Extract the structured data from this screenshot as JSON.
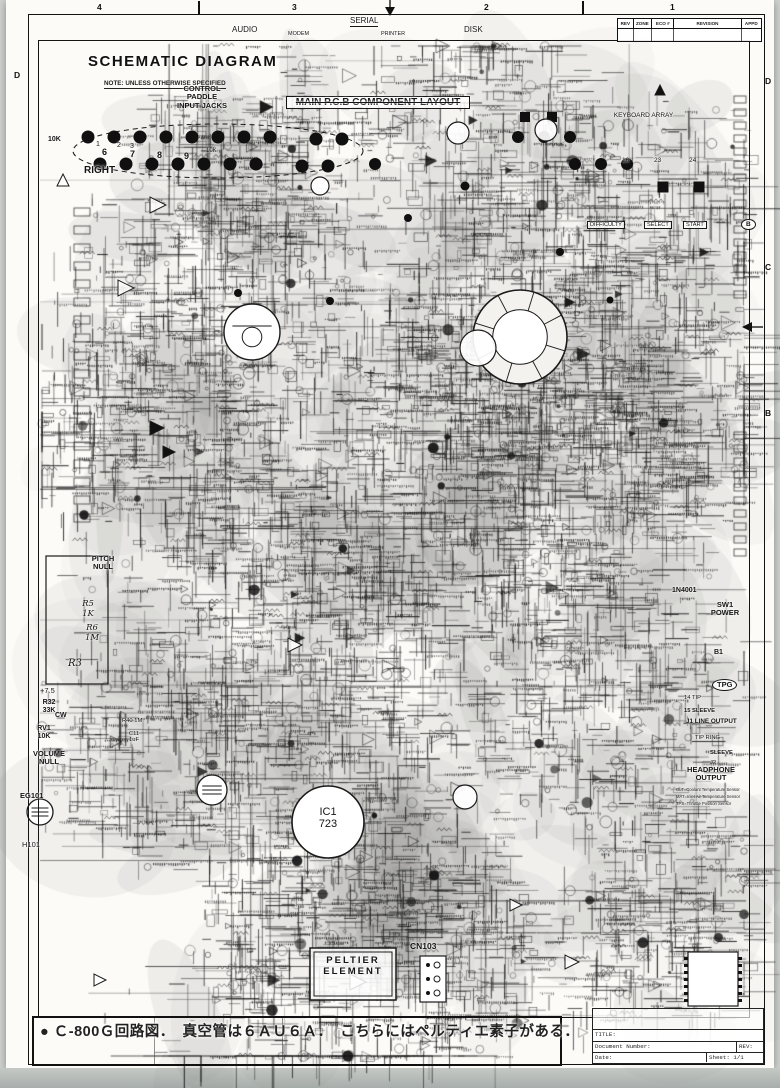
{
  "header": {
    "title": "SCHEMATIC DIAGRAM",
    "note": "NOTE: UNLESS OTHERWISE SPECIFIED"
  },
  "zones": {
    "top": [
      {
        "label": "4",
        "x": 100
      },
      {
        "label": "3",
        "x": 295
      },
      {
        "label": "2",
        "x": 487
      },
      {
        "label": "1",
        "x": 673
      }
    ],
    "left": [
      {
        "label": "D",
        "y": 70
      }
    ],
    "right": [
      {
        "label": "D",
        "y": 76
      },
      {
        "label": "C",
        "y": 262
      },
      {
        "label": "B",
        "y": 408
      }
    ],
    "ticks_top": [
      198,
      582
    ]
  },
  "revision_table": {
    "headers": [
      "REV",
      "ZONE",
      "ECO #",
      "REVISION",
      "APPD"
    ]
  },
  "title_block": {
    "title_label": "TITLE:",
    "doc_label": "Document Number:",
    "rev_label": "REV:",
    "date_label": "Date:",
    "sheet_label": "Sheet: 1/1"
  },
  "caption": {
    "text": "● Ｃ-800Ｇ回路図．　真空管は６ＡＵ６Ａ．　こちらにはペルティエ素子がある．"
  },
  "colors": {
    "ink": "#1a1a1a",
    "paper": "#fcfbf8",
    "smudge": "#8a8a8a"
  },
  "callouts": [
    {
      "name": "label-audio",
      "text": "AUDIO",
      "x": 232,
      "y": 26,
      "size": 8
    },
    {
      "name": "label-serial",
      "text": "SERIAL",
      "x": 350,
      "y": 17,
      "size": 8,
      "underline": true
    },
    {
      "name": "label-modem",
      "text": "MODEM",
      "x": 288,
      "y": 31,
      "size": 5.5
    },
    {
      "name": "label-printer",
      "text": "PRINTER",
      "x": 381,
      "y": 31,
      "size": 5.5
    },
    {
      "name": "label-disk",
      "text": "DISK",
      "x": 464,
      "y": 26,
      "size": 8
    },
    {
      "name": "label-control-paddle-input-jacks",
      "text": "CONTROL\nPADDLE\nINPUT JACKS",
      "x": 166,
      "y": 85,
      "size": 7.5,
      "w": 72,
      "bold": true
    },
    {
      "name": "label-10k-a",
      "text": "10K",
      "x": 48,
      "y": 136,
      "size": 7,
      "bold": true
    },
    {
      "name": "label-10k-b",
      "text": "10K",
      "x": 206,
      "y": 148,
      "size": 6
    },
    {
      "name": "label-right",
      "text": "RIGHT",
      "x": 84,
      "y": 165,
      "size": 10,
      "bold": true
    },
    {
      "name": "label-num-1",
      "text": "1",
      "x": 96,
      "y": 141,
      "size": 7
    },
    {
      "name": "label-num-2",
      "text": "2",
      "x": 117,
      "y": 142,
      "size": 7
    },
    {
      "name": "label-num-3",
      "text": "3",
      "x": 130,
      "y": 143,
      "size": 7
    },
    {
      "name": "label-num-6",
      "text": "6",
      "x": 102,
      "y": 147,
      "size": 9,
      "bold": true
    },
    {
      "name": "label-num-7",
      "text": "7",
      "x": 130,
      "y": 149,
      "size": 9,
      "bold": true
    },
    {
      "name": "label-num-8",
      "text": "8",
      "x": 157,
      "y": 150,
      "size": 9,
      "bold": true
    },
    {
      "name": "label-num-9",
      "text": "9",
      "x": 184,
      "y": 151,
      "size": 9,
      "bold": true
    },
    {
      "name": "label-main-pcb-layout",
      "text": "MAIN P.C.B COMPONENT LAYOUT",
      "x": 286,
      "y": 96,
      "size": 10,
      "bold": true,
      "box": true,
      "w": 178,
      "strike": true
    },
    {
      "name": "label-keyboard-array",
      "text": "KEYBOARD ARRAY",
      "x": 596,
      "y": 112,
      "size": 6.5,
      "w": 95
    },
    {
      "name": "label-pin-16",
      "text": "16",
      "x": 622,
      "y": 157,
      "size": 6.5
    },
    {
      "name": "label-pin-23",
      "text": "23",
      "x": 654,
      "y": 157,
      "size": 6.5
    },
    {
      "name": "label-pin-24",
      "text": "24",
      "x": 689,
      "y": 157,
      "size": 6.5
    },
    {
      "name": "label-difficulty",
      "text": "DIFFICULTY",
      "x": 587,
      "y": 221,
      "size": 5.6,
      "box": true
    },
    {
      "name": "label-select",
      "text": "SELECT",
      "x": 644,
      "y": 221,
      "size": 5.6,
      "box": true
    },
    {
      "name": "label-start",
      "text": "START",
      "x": 683,
      "y": 221,
      "size": 5.6,
      "box": true
    },
    {
      "name": "balloon-b",
      "text": "B",
      "x": 741,
      "y": 219,
      "size": 6.5,
      "oval": true,
      "bold": true
    },
    {
      "name": "label-pitch-null",
      "text": "PITCH\nNULL",
      "x": 84,
      "y": 555,
      "size": 7.5,
      "bold": true,
      "w": 38
    },
    {
      "name": "label-r5-1k",
      "text": "R5\n1K",
      "x": 76,
      "y": 600,
      "size": 8.5,
      "w": 24,
      "italic": true
    },
    {
      "name": "label-r6-1m",
      "text": "R6\n1M",
      "x": 80,
      "y": 624,
      "size": 8.5,
      "w": 24,
      "italic": true
    },
    {
      "name": "label-r3",
      "text": "R3",
      "x": 68,
      "y": 658,
      "size": 10,
      "italic": true
    },
    {
      "name": "label-plus-7-5",
      "text": "+7.5",
      "x": 40,
      "y": 687,
      "size": 7.5
    },
    {
      "name": "label-r32-33k",
      "text": "R32\n33K",
      "x": 36,
      "y": 699,
      "size": 7,
      "bold": true,
      "w": 26
    },
    {
      "name": "label-cw",
      "text": "CW",
      "x": 55,
      "y": 712,
      "size": 7,
      "bold": true
    },
    {
      "name": "label-rv1-10k",
      "text": "RV1\n10K",
      "x": 31,
      "y": 725,
      "size": 7,
      "bold": true,
      "w": 26
    },
    {
      "name": "label-r40-1m",
      "text": "R40 1M",
      "x": 122,
      "y": 718,
      "size": 5.8
    },
    {
      "name": "label-c11-1uf",
      "text": "C11\n1uF",
      "x": 124,
      "y": 731,
      "size": 5.8,
      "w": 20
    },
    {
      "name": "label-volume-null",
      "text": "VOLUME\nNULL",
      "x": 26,
      "y": 750,
      "size": 7.5,
      "bold": true,
      "w": 46
    },
    {
      "name": "label-eg101",
      "text": "EG101",
      "x": 20,
      "y": 792,
      "size": 7.5,
      "bold": true
    },
    {
      "name": "label-h101",
      "text": "H101",
      "x": 22,
      "y": 841,
      "size": 7.5
    },
    {
      "name": "label-ic1-723",
      "text": "IC1\n723",
      "x": 303,
      "y": 806,
      "size": 11,
      "w": 50
    },
    {
      "name": "label-peltier-element",
      "text": "PELTIER\nELEMENT",
      "x": 316,
      "y": 956,
      "size": 9.5,
      "bold": true,
      "w": 74,
      "spaced": true
    },
    {
      "name": "label-cn103",
      "text": "CN103",
      "x": 410,
      "y": 942,
      "size": 8.5,
      "bold": true
    },
    {
      "name": "label-1n4001",
      "text": "1N4001",
      "x": 672,
      "y": 587,
      "size": 7,
      "bold": true
    },
    {
      "name": "label-sw1-power",
      "text": "SW1\nPOWER",
      "x": 704,
      "y": 601,
      "size": 7.5,
      "bold": true,
      "w": 42
    },
    {
      "name": "label-b1",
      "text": "B1",
      "x": 714,
      "y": 649,
      "size": 7,
      "bold": true
    },
    {
      "name": "label-tpg",
      "text": "TPG",
      "x": 712,
      "y": 679,
      "size": 7.5,
      "bold": true,
      "oval": true
    },
    {
      "name": "label-14-tip",
      "text": "14  TIP",
      "x": 684,
      "y": 695,
      "size": 5.8
    },
    {
      "name": "label-15-sleeve",
      "text": "15   SLEEVE",
      "x": 684,
      "y": 708,
      "size": 5.8,
      "bold": true
    },
    {
      "name": "label-j1-line-output",
      "text": "J1 LINE OUTPUT",
      "x": 686,
      "y": 718,
      "size": 6.3,
      "bold": true
    },
    {
      "name": "label-tip-ring",
      "text": "TIP  RING",
      "x": 695,
      "y": 735,
      "size": 5.8
    },
    {
      "name": "label-sleeve",
      "text": "SLEEVE",
      "x": 710,
      "y": 750,
      "size": 5.8,
      "bold": true
    },
    {
      "name": "label-j2",
      "text": "J2",
      "x": 710,
      "y": 760,
      "size": 5.8
    },
    {
      "name": "label-headphone-output",
      "text": "HEADPHONE\nOUTPUT",
      "x": 678,
      "y": 766,
      "size": 7.5,
      "bold": true,
      "w": 66
    },
    {
      "name": "label-olt-sensor",
      "text": "OLT=Coolant Temperature Sensor",
      "x": 676,
      "y": 788,
      "size": 4.2
    },
    {
      "name": "label-mat-sensor",
      "text": "MAT=Inlet Air Temperature Sensor",
      "x": 676,
      "y": 795,
      "size": 4.2
    },
    {
      "name": "label-tps-sensor",
      "text": "TPS=Throttle Position Sensor",
      "x": 676,
      "y": 802,
      "size": 4.2
    }
  ],
  "diagram": {
    "dots": [
      [
        88,
        137,
        6.5
      ],
      [
        114,
        137,
        6.5
      ],
      [
        140,
        137,
        6.5
      ],
      [
        166,
        137,
        6.5
      ],
      [
        192,
        137,
        6.5
      ],
      [
        218,
        137,
        6.5
      ],
      [
        244,
        137,
        6.5
      ],
      [
        270,
        137,
        6.5
      ],
      [
        316,
        139,
        6.5
      ],
      [
        342,
        139,
        6.5
      ],
      [
        518,
        137,
        6
      ],
      [
        544,
        137,
        6
      ],
      [
        570,
        137,
        6
      ],
      [
        100,
        164,
        6.5
      ],
      [
        126,
        164,
        6.5
      ],
      [
        152,
        164,
        6.5
      ],
      [
        178,
        164,
        6.5
      ],
      [
        204,
        164,
        6.5
      ],
      [
        230,
        164,
        6.5
      ],
      [
        256,
        164,
        6.5
      ],
      [
        302,
        166,
        6.5
      ],
      [
        328,
        166,
        6.5
      ],
      [
        375,
        164,
        6
      ],
      [
        575,
        164,
        6
      ],
      [
        601,
        164,
        6
      ],
      [
        627,
        164,
        6
      ],
      [
        330,
        301,
        4
      ],
      [
        238,
        293,
        4
      ],
      [
        465,
        186,
        4.5
      ],
      [
        408,
        218,
        4
      ],
      [
        560,
        252,
        4
      ],
      [
        610,
        300,
        3.5
      ]
    ],
    "squares": [
      [
        663,
        187,
        11
      ],
      [
        699,
        187,
        11
      ],
      [
        525,
        117,
        10
      ],
      [
        552,
        117,
        10
      ]
    ],
    "circles": [
      {
        "cx": 252,
        "cy": 332,
        "r": 28,
        "kind": "tube"
      },
      {
        "cx": 520,
        "cy": 337,
        "r": 47,
        "kind": "tube-big"
      },
      {
        "cx": 478,
        "cy": 348,
        "r": 18,
        "kind": "plain"
      },
      {
        "cx": 328,
        "cy": 822,
        "r": 36,
        "kind": "ic"
      },
      {
        "cx": 40,
        "cy": 812,
        "r": 13,
        "kind": "tube-small"
      },
      {
        "cx": 212,
        "cy": 790,
        "r": 15,
        "kind": "tube-small"
      },
      {
        "cx": 458,
        "cy": 133,
        "r": 11,
        "kind": "plain"
      },
      {
        "cx": 546,
        "cy": 130,
        "r": 11,
        "kind": "plain"
      },
      {
        "cx": 320,
        "cy": 186,
        "r": 9,
        "kind": "plain"
      },
      {
        "cx": 465,
        "cy": 797,
        "r": 12,
        "kind": "plain"
      }
    ],
    "triangles": [
      [
        150,
        428,
        14,
        "r",
        1
      ],
      [
        163,
        452,
        12,
        "r",
        1
      ],
      [
        118,
        288,
        16,
        "r",
        0
      ],
      [
        150,
        205,
        16,
        "r",
        0
      ],
      [
        63,
        186,
        12,
        "u",
        0
      ],
      [
        350,
        982,
        16,
        "r",
        0
      ],
      [
        565,
        962,
        14,
        "r",
        0
      ],
      [
        288,
        645,
        14,
        "r",
        0
      ],
      [
        510,
        905,
        12,
        "r",
        0
      ],
      [
        94,
        980,
        12,
        "r",
        0
      ],
      [
        660,
        95,
        10,
        "u",
        1
      ]
    ],
    "boxes": [
      {
        "x": 310,
        "y": 948,
        "w": 86,
        "h": 52,
        "kind": "double"
      },
      {
        "x": 420,
        "y": 956,
        "w": 26,
        "h": 46,
        "kind": "connector"
      },
      {
        "x": 688,
        "y": 952,
        "w": 50,
        "h": 54,
        "kind": "dip"
      },
      {
        "x": 46,
        "y": 556,
        "w": 62,
        "h": 128,
        "kind": "plain"
      }
    ],
    "arrows": [
      [
        390,
        16,
        "down"
      ],
      [
        750,
        327,
        "left"
      ]
    ],
    "dashed_outline": {
      "cx": 218,
      "cy": 151,
      "rx": 145,
      "ry": 27
    }
  }
}
